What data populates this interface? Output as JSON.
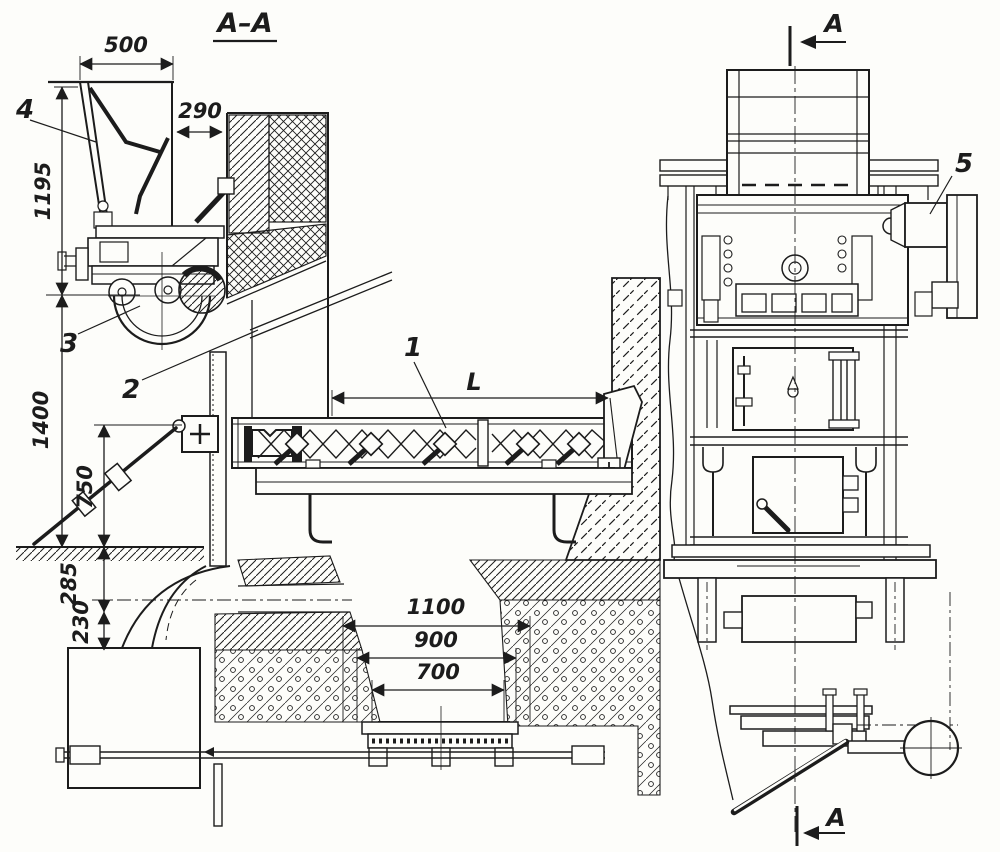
{
  "drawing": {
    "section_title": "A–A",
    "colors": {
      "ink": "#1c1c1c",
      "paper": "#fdfdfa"
    },
    "dims": {
      "d500": "500",
      "d290": "290",
      "d1195": "1195",
      "d1400": "1400",
      "d750": "750",
      "d285": "285",
      "d230": "230",
      "d1100": "1100",
      "d900": "900",
      "d700": "700",
      "dL": "L"
    },
    "callouts": {
      "c1": "1",
      "c2": "2",
      "c3": "3",
      "c4": "4",
      "c5": "5"
    },
    "marks": {
      "top": "A",
      "bottom": "A"
    }
  }
}
